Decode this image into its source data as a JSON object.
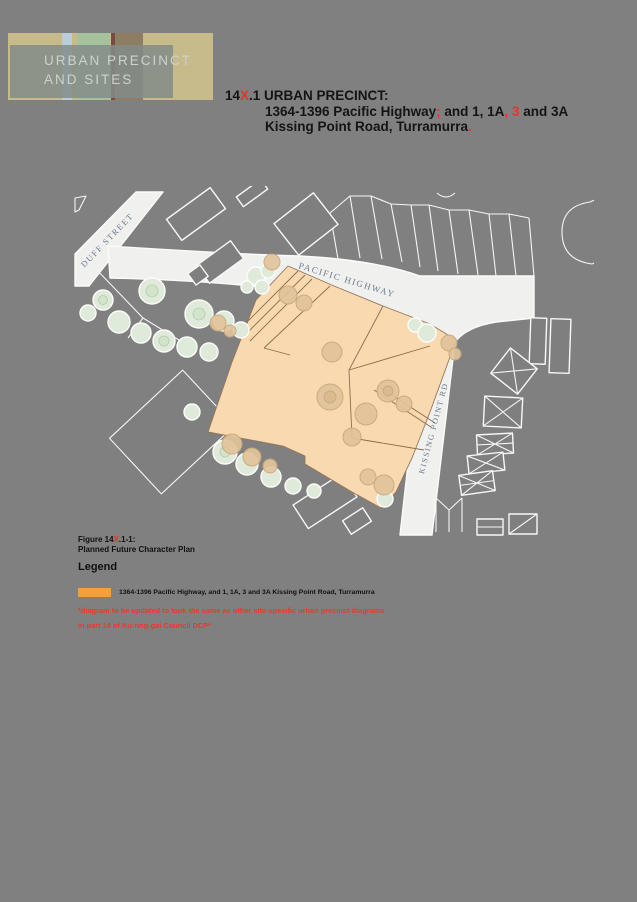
{
  "page": {
    "background": "#808080"
  },
  "banner": {
    "line1": "URBAN PRECINCT",
    "line2": "AND SITES"
  },
  "title": {
    "accent_color": "#e8332a",
    "line1": [
      {
        "t": "14"
      },
      {
        "t": "X",
        "red": true
      },
      {
        "t": ".1 URBAN PRECINCT:"
      }
    ],
    "line2": [
      {
        "t": "1364-1396 Pacific Highway"
      },
      {
        "t": ";",
        "red": true
      },
      {
        "t": " and 1, 1A"
      },
      {
        "t": ",",
        "red": true
      },
      {
        "t": " "
      },
      {
        "t": "3",
        "red": true
      },
      {
        "t": " and 3A"
      }
    ],
    "line3": [
      {
        "t": "Kissing Point Road, Turramurra"
      },
      {
        "t": ".",
        "red": true
      }
    ]
  },
  "map": {
    "labels": {
      "duff_street": "DUFF STREET",
      "pacific_highway": "PACIFIC HIGHWAY",
      "kissing_point_rd": "KISSING POINT RD"
    },
    "precinct_fill": "#f8d9b0"
  },
  "figure": {
    "caption_line1": [
      {
        "t": "Figure 14"
      },
      {
        "t": "X",
        "red": true
      },
      {
        "t": ".1-1:"
      }
    ],
    "caption_line2": "Planned Future Character Plan"
  },
  "legend": {
    "heading": "Legend",
    "swatch_color": "#f2a03a",
    "item_label": "1364-1396 Pacific Highway, and 1, 1A, 3 and 3A Kissing Point Road, Turramurra"
  },
  "note": {
    "color": "#e8392f",
    "line1": "*diagram to be updated to look the same as other site-specific urban precinct diagrams",
    "line2": "in part 14 of Ku-ring-gai Council DCP*"
  }
}
